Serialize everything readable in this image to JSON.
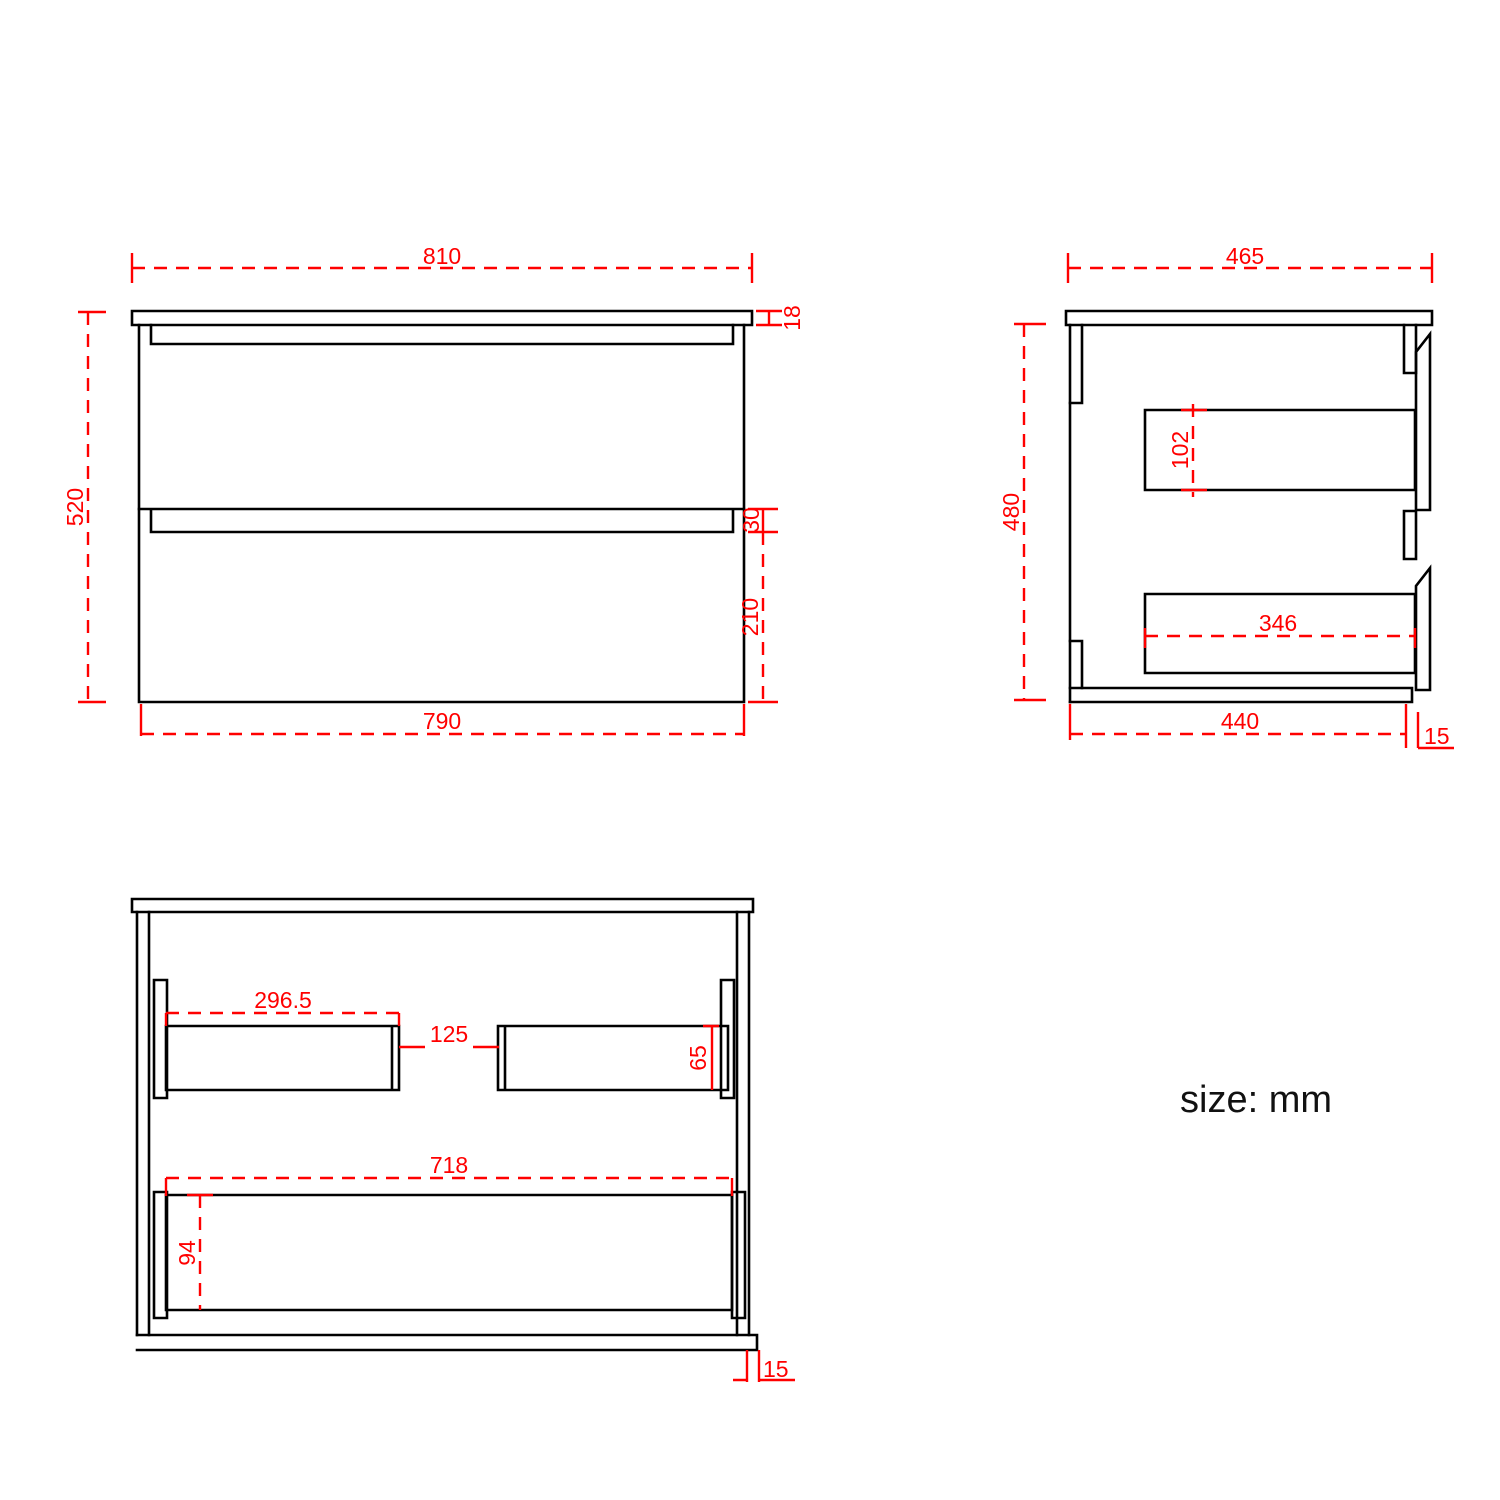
{
  "note": {
    "units": "size: mm"
  },
  "colors": {
    "dimension": "#ff0000",
    "outline": "#000000",
    "background": "#ffffff"
  },
  "views": {
    "front": {
      "width_top": "810",
      "countertop_thickness": "18",
      "height_total": "520",
      "drawer_gap": "30",
      "drawer_front_height": "210",
      "width_body": "790"
    },
    "side": {
      "depth_top": "465",
      "height_body": "480",
      "drawer_inner_height": "102",
      "drawer_inner_depth": "346",
      "depth_body": "440",
      "overhang": "15"
    },
    "plan": {
      "left_drawer_width": "296.5",
      "center_gap": "125",
      "drawer_side_height": "65",
      "drawer_width": "718",
      "drawer_side_depth": "94",
      "overhang": "15"
    }
  }
}
